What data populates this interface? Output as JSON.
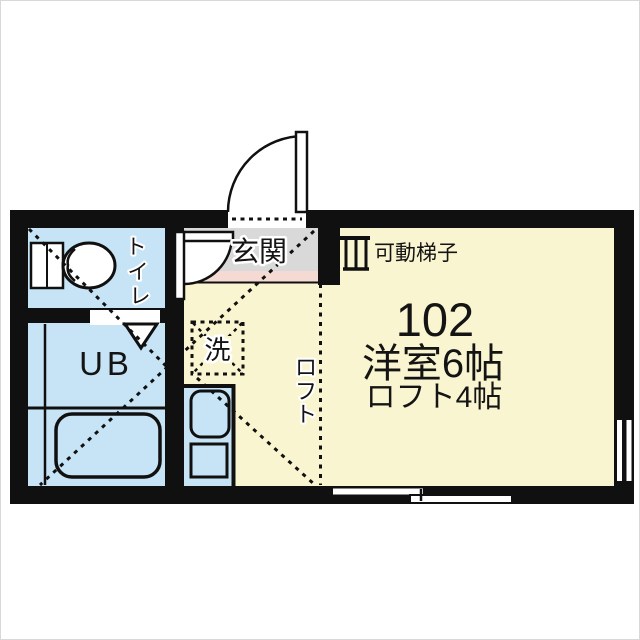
{
  "floorplan": {
    "unit_number": "102",
    "room_area_label": "洋室6帖",
    "loft_area_label": "ロフト4帖",
    "entrance_label": "玄関",
    "ladder_label": "可動梯子",
    "unit_bath_label": "UB",
    "washing_machine_label": "洗",
    "toilet_label_chars": [
      "ト",
      "イ",
      "レ"
    ],
    "loft_label_chars": [
      "ロ",
      "フ",
      "ト"
    ],
    "colors": {
      "wall": "#101010",
      "room_floor": "#FAF5D1",
      "wet_area": "#C6E4F6",
      "entrance": "#D9D9D9",
      "entrance_step": "#F4DAD2",
      "background": "#FFFFFF"
    }
  }
}
